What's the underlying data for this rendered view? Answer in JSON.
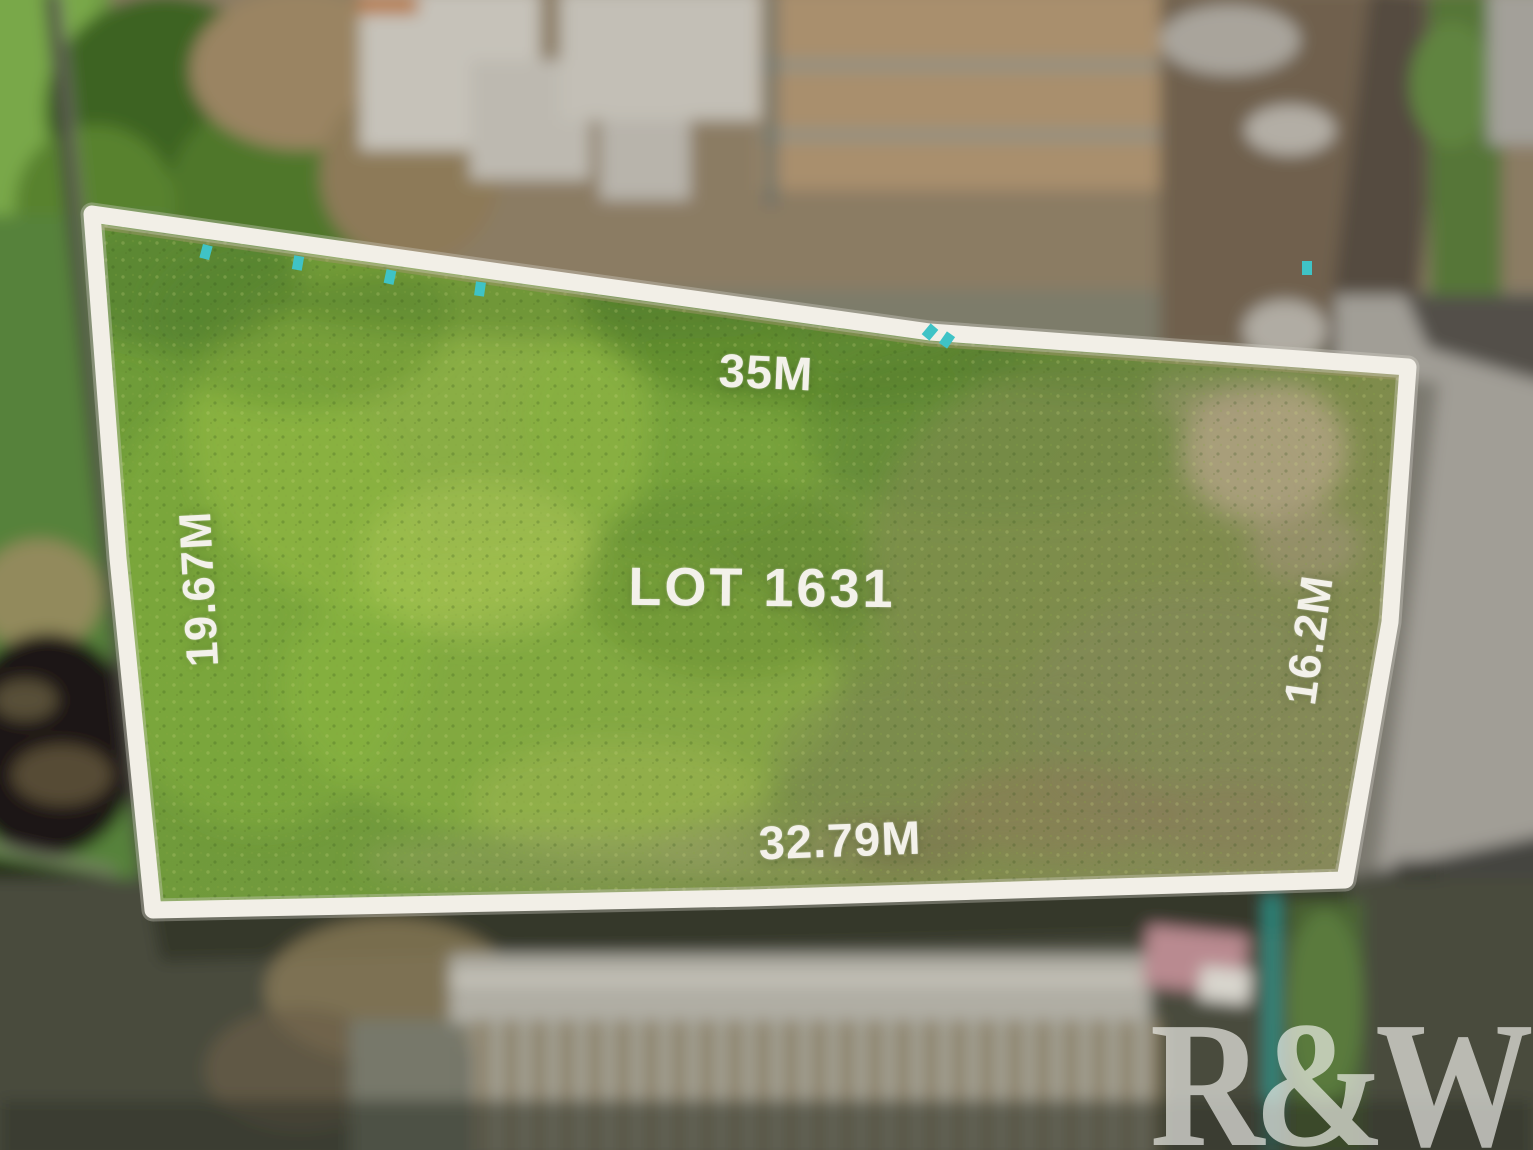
{
  "image": {
    "lot": {
      "number_label": "LOT 1631",
      "side_lengths": {
        "top": "35M",
        "left": "19.67M",
        "right": "16.2M",
        "bottom": "32.79M"
      }
    },
    "watermark": {
      "text": "R&W"
    },
    "colors": {
      "boundary_line": "#f2efe7",
      "survey_peg": "#3fc3c6",
      "grass_bright": "#8ab63e",
      "grass_olive": "#808a50",
      "sand_patch": "#b0a283",
      "road_light": "#a19e96",
      "road_shadow": "#454540",
      "burnt_ground": "#1a1812"
    }
  }
}
